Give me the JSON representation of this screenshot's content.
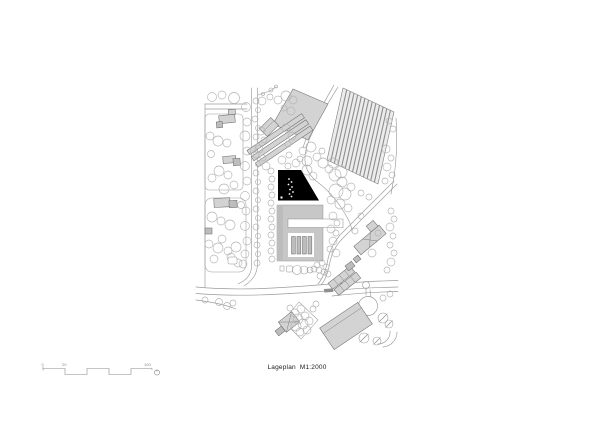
{
  "sheet": {
    "caption": "Lageplan  M1:2000"
  },
  "scale_bar": {
    "tick_labels": [
      "0",
      "20",
      "100"
    ]
  },
  "colors": {
    "paper": "#ffffff",
    "building_fill": "#d3d3d3",
    "building_fill_dark": "#bdbdbd",
    "building_stroke": "#6e6e6e",
    "complex_fill": "#c7c7c7",
    "project_black": "#000000",
    "road": "#9b9b9b",
    "tree": "#b3b3b3",
    "field_fill": "#ececec",
    "field_stripe": "#8e8e8e",
    "text": "#1a1a1a",
    "scale": "#8a8a8a"
  }
}
